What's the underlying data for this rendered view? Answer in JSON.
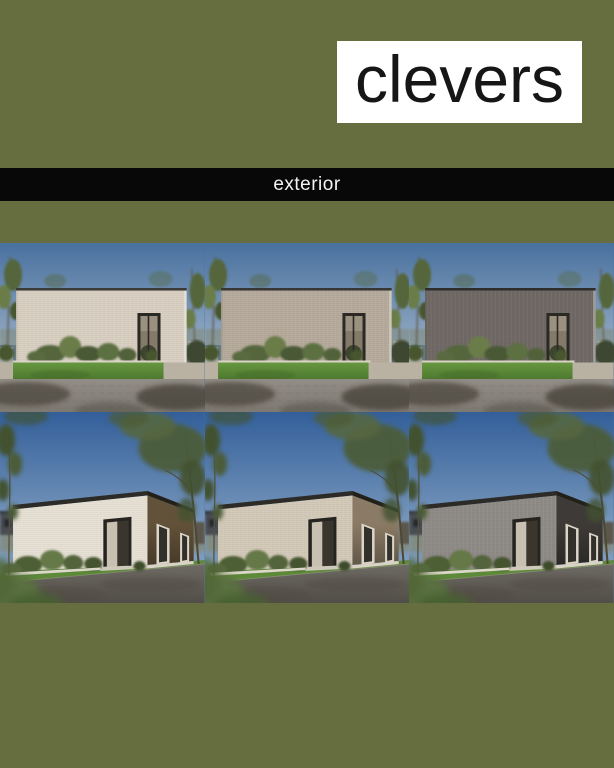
{
  "page": {
    "background": "#666d3e",
    "width": 614,
    "height": 768
  },
  "logo": {
    "text": "clevers",
    "box_color": "#ffffff",
    "text_color": "#161616"
  },
  "section_bar": {
    "label": "exterior",
    "bar_color": "#080808",
    "text_color": "#f3f3f3"
  },
  "gallery": {
    "description": "Six exterior renders of a flat-roof house: top row straight front elevations, bottom row street-corner perspective, each with a different facade finish",
    "palette": {
      "front_view": {
        "sky_top": "#49719f",
        "sky_bottom": "#93aac3",
        "grass_top": "#679740",
        "grass_bottom": "#4e7a2f",
        "pave_top": "#928d86",
        "pave_bottom": "#7d7871",
        "shadow": "#3b352c",
        "foliage_dark": "#47562f",
        "foliage_mid": "#55663d",
        "foliage_light": "#6b7d49",
        "trunk": "#5f5948",
        "path": "#b9b2a3",
        "planter": "#d9d4c7",
        "door_frame": "#2b2924",
        "door_glass": "#837a69"
      },
      "angle_view": {
        "sky_top": "#335f9a",
        "sky_bottom": "#7c9bbe",
        "road_top": "#6e6a64",
        "road_bottom": "#514d47",
        "grass": "#5d8a39",
        "fascia": "#2d2b27",
        "base_strip": "#d8d3c6",
        "window_frame": "#dcd6c8",
        "window_glass": "#31302b",
        "door_frame": "#262420",
        "door_panel": "#3a362e",
        "inner_wall": "#c8c1b2",
        "trunk": "#56503e",
        "foliage_dark": "#42512e",
        "foliage_mid": "#4c5c38",
        "foliage_light": "#556740"
      }
    },
    "tiles": [
      {
        "view": "front",
        "alt": "front elevation, cream brick facade",
        "facade": "#d8cfc1",
        "roof": "#3c3a36"
      },
      {
        "view": "front",
        "alt": "front elevation, greige brick facade",
        "facade": "#b5aa9b",
        "roof": "#393733"
      },
      {
        "view": "front",
        "alt": "front elevation, dark grey brick facade",
        "facade": "#6f6864",
        "roof": "#2f2d2a"
      },
      {
        "view": "angle",
        "alt": "corner view, cream front with dark bronze brick side",
        "front": "#e6e0d4",
        "side": "#63523a"
      },
      {
        "view": "angle",
        "alt": "corner view, greige front with taupe brick side",
        "front": "#d3c9b8",
        "side": "#8b7b66"
      },
      {
        "view": "angle",
        "alt": "corner view, grey front with charcoal brick side",
        "front": "#8e8a86",
        "side": "#3d3a37"
      }
    ]
  }
}
